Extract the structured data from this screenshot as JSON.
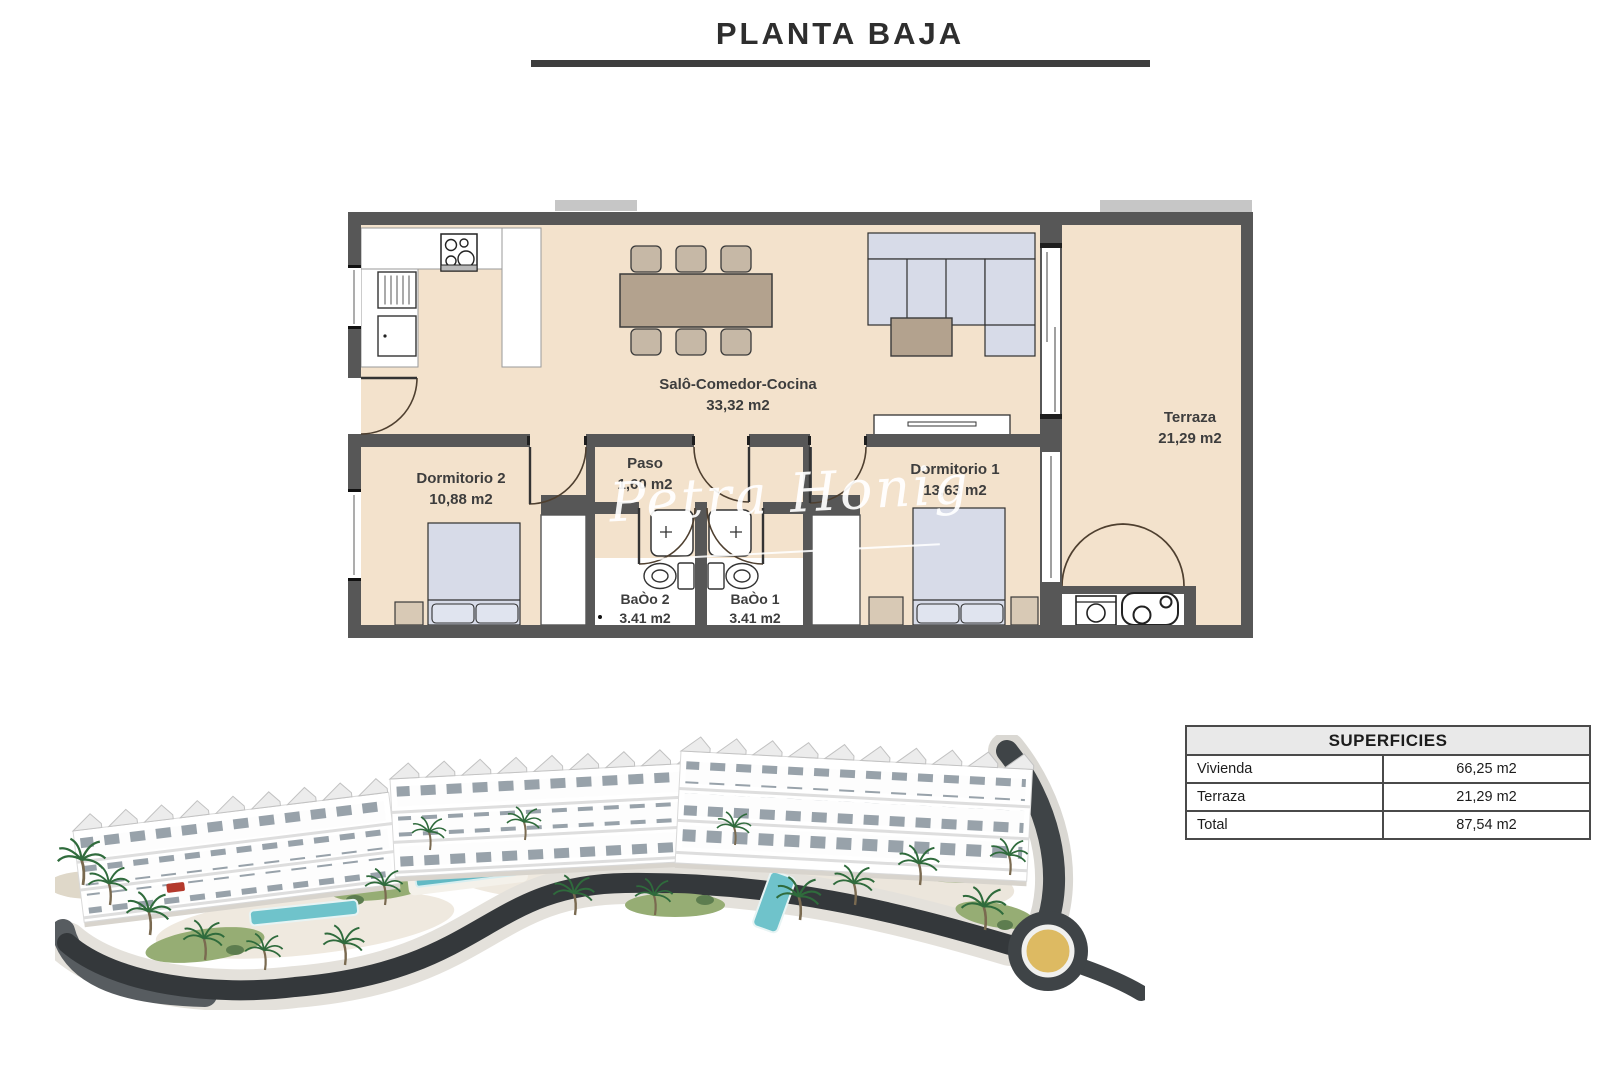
{
  "title": "PLANTA BAJA",
  "floorplan": {
    "rooms": [
      {
        "name": "Salô-Comedor-Cocina",
        "area": "33,32 m2"
      },
      {
        "name": "Terraza",
        "area": "21,29 m2"
      },
      {
        "name": "Dormitorio 2",
        "area": "10,88 m2"
      },
      {
        "name": "Paso",
        "area": "1,60 m2"
      },
      {
        "name": "Dormitorio 1",
        "area": "13,63 m2"
      },
      {
        "name": "BaÒo 2",
        "area": "3.41 m2"
      },
      {
        "name": "BaÒo 1",
        "area": "3.41 m2"
      }
    ],
    "colors": {
      "floor": "#f3e2cc",
      "walls": "#575757",
      "furniture_blue": "#d7dbe8",
      "furniture_wood": "#b3a28e"
    }
  },
  "watermark": "Petra Honig",
  "surfaces": {
    "header": "SUPERFICIES",
    "rows": [
      {
        "label": "Vivienda",
        "value": "66,25 m2"
      },
      {
        "label": "Terraza",
        "value": "21,29 m2"
      },
      {
        "label": "Total",
        "value": "87,54 m2"
      }
    ]
  }
}
